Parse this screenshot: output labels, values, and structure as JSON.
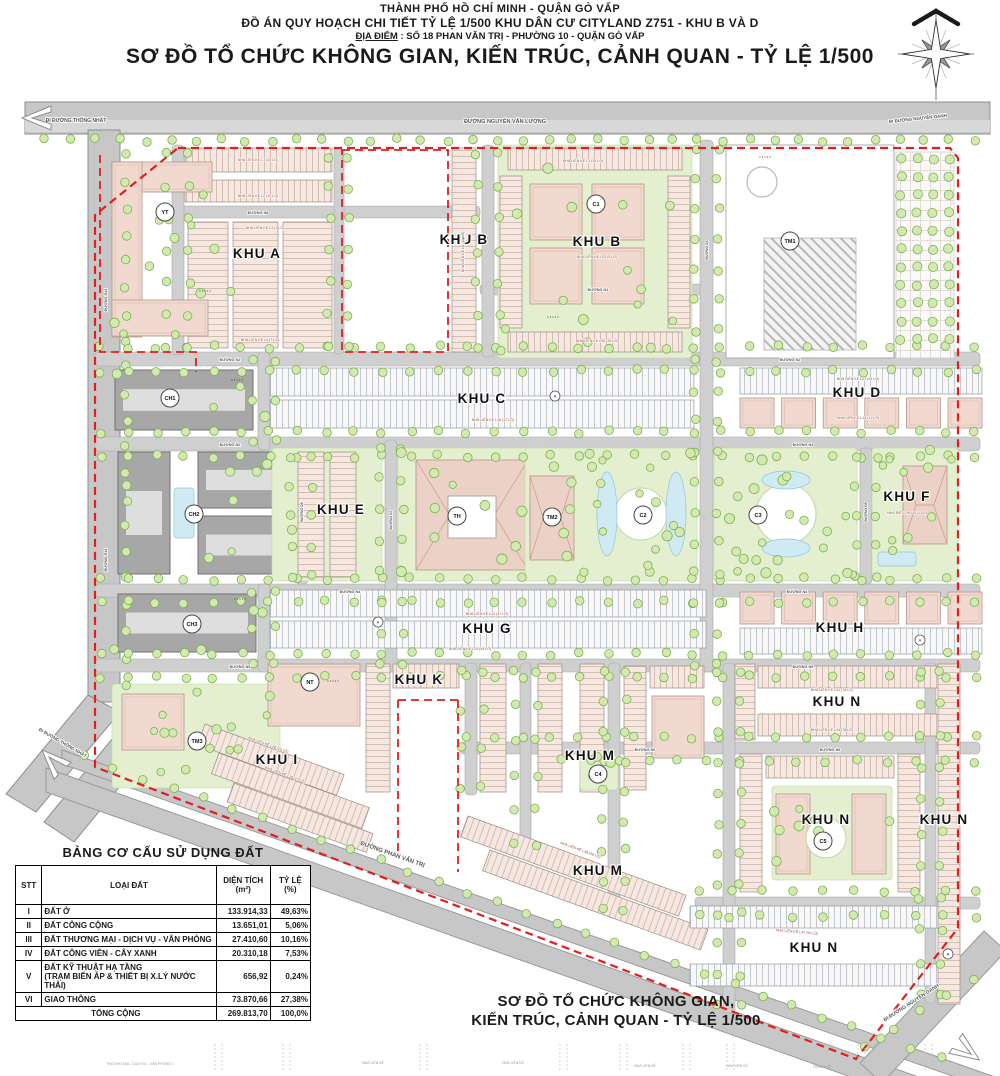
{
  "header": {
    "line1": "THÀNH PHỐ HỒ CHÍ MINH - QUẬN GÒ VẤP",
    "line2": "ĐỒ ÁN QUY HOẠCH CHI TIẾT TỶ LỆ 1/500 KHU DÂN CƯ CITYLAND Z751 - KHU B VÀ D",
    "line3_label": "ĐỊA ĐIỂM",
    "line3_rest": " : SỐ 18 PHAN VĂN TRỊ - PHƯỜNG 10 - QUẬN GÒ VẤP",
    "title": "SƠ ĐỒ TỔ CHỨC KHÔNG GIAN, KIẾN TRÚC, CẢNH QUAN - TỶ LỆ 1/500"
  },
  "caption": {
    "line1": "SƠ ĐỒ TỔ CHỨC KHÔNG GIAN,",
    "line2": "KIẾN TRÚC, CẢNH QUAN - TỶ LỆ 1/500"
  },
  "land_use_table": {
    "title": "BẢNG CƠ CẤU SỬ DỤNG ĐẤT",
    "columns": [
      "STT",
      "LOẠI ĐẤT",
      "DIỆN TÍCH\n(m²)",
      "TỶ LỆ\n(%)"
    ],
    "rows": [
      {
        "stt": "I",
        "loai": "ĐẤT Ở",
        "dien_tich": "133.914,33",
        "ty_le": "49,63%"
      },
      {
        "stt": "II",
        "loai": "ĐẤT CÔNG CỘNG",
        "dien_tich": "13.651,01",
        "ty_le": "5,06%"
      },
      {
        "stt": "III",
        "loai": "ĐẤT THƯƠNG MẠI - DỊCH VỤ - VĂN PHÒNG",
        "dien_tich": "27.410,60",
        "ty_le": "10,16%"
      },
      {
        "stt": "IV",
        "loai": "ĐẤT CÔNG VIÊN - CÂY XANH",
        "dien_tich": "20.310,18",
        "ty_le": "7,53%"
      },
      {
        "stt": "V",
        "loai": "ĐẤT KỸ THUẬT HẠ TẦNG\n(TRẠM BIẾN ÁP & THIẾT BỊ X.LÝ NƯỚC THẢI)",
        "dien_tich": "656,92",
        "ty_le": "0,24%"
      },
      {
        "stt": "VI",
        "loai": "GIAO THÔNG",
        "dien_tich": "73.870,66",
        "ty_le": "27,38%"
      }
    ],
    "total": {
      "label": "TỔNG CỘNG",
      "dien_tich": "269.813,70",
      "ty_le": "100,0%"
    }
  },
  "map": {
    "zones": [
      {
        "label": "KHU A",
        "x": 257,
        "y": 258
      },
      {
        "label": "KHU B",
        "x": 464,
        "y": 244
      },
      {
        "label": "KHU B",
        "x": 597,
        "y": 246
      },
      {
        "label": "KHU C",
        "x": 482,
        "y": 403
      },
      {
        "label": "KHU D",
        "x": 857,
        "y": 397
      },
      {
        "label": "KHU E",
        "x": 341,
        "y": 514
      },
      {
        "label": "KHU F",
        "x": 907,
        "y": 501
      },
      {
        "label": "KHU G",
        "x": 487,
        "y": 633
      },
      {
        "label": "KHU H",
        "x": 840,
        "y": 632
      },
      {
        "label": "KHU I",
        "x": 277,
        "y": 764
      },
      {
        "label": "KHU K",
        "x": 419,
        "y": 684
      },
      {
        "label": "KHU M",
        "x": 590,
        "y": 760
      },
      {
        "label": "KHU M",
        "x": 598,
        "y": 875
      },
      {
        "label": "KHU N",
        "x": 837,
        "y": 706
      },
      {
        "label": "KHU N",
        "x": 826,
        "y": 824
      },
      {
        "label": "KHU N",
        "x": 944,
        "y": 824
      },
      {
        "label": "KHU N",
        "x": 814,
        "y": 952
      }
    ],
    "facilities": [
      {
        "label": "YT",
        "x": 165,
        "y": 212
      },
      {
        "label": "C1",
        "x": 596,
        "y": 204
      },
      {
        "label": "TM1",
        "x": 790,
        "y": 241
      },
      {
        "label": "CH1",
        "x": 170,
        "y": 398
      },
      {
        "label": "CH2",
        "x": 194,
        "y": 514
      },
      {
        "label": "TM2",
        "x": 552,
        "y": 517
      },
      {
        "label": "TH",
        "x": 457,
        "y": 516
      },
      {
        "label": "C2",
        "x": 643,
        "y": 515
      },
      {
        "label": "C3",
        "x": 758,
        "y": 515
      },
      {
        "label": "CH3",
        "x": 192,
        "y": 624
      },
      {
        "label": "NT",
        "x": 310,
        "y": 682
      },
      {
        "label": "TM3",
        "x": 197,
        "y": 741
      },
      {
        "label": "C4",
        "x": 598,
        "y": 774
      },
      {
        "label": "C5",
        "x": 823,
        "y": 841
      }
    ],
    "small_circles": [
      {
        "label": "A",
        "x": 555,
        "y": 396
      },
      {
        "label": "A",
        "x": 378,
        "y": 622
      },
      {
        "label": "A",
        "x": 920,
        "y": 640
      },
      {
        "label": "A",
        "x": 948,
        "y": 954
      }
    ],
    "road_labels": [
      {
        "text": "ĐI ĐƯỜNG THỐNG NHẤT",
        "x": 76,
        "y": 122,
        "a": 0,
        "s": 5
      },
      {
        "text": "ĐƯỜNG NGUYỄN VĂN LƯỢNG",
        "x": 505,
        "y": 123,
        "a": 0,
        "s": 5.5
      },
      {
        "text": "ĐI ĐƯỜNG NGUYỄN OANH",
        "x": 918,
        "y": 120,
        "a": -6,
        "s": 4.5
      },
      {
        "text": "ĐI ĐƯỜNG THỐNG NHẤT",
        "x": 62,
        "y": 744,
        "a": 30,
        "s": 4.5
      },
      {
        "text": "ĐƯỜNG PHAN VĂN TRỊ",
        "x": 392,
        "y": 856,
        "a": 19.5,
        "s": 6
      },
      {
        "text": "ĐI ĐƯỜNG NGUYỄN OANH",
        "x": 912,
        "y": 1004,
        "a": -33,
        "s": 5
      },
      {
        "text": "ĐƯỜNG N8",
        "x": 258,
        "y": 214,
        "a": 0,
        "s": 3.8
      },
      {
        "text": "ĐƯỜNG N1",
        "x": 598,
        "y": 291,
        "a": 0,
        "s": 3.8
      },
      {
        "text": "ĐƯỜNG N2",
        "x": 230,
        "y": 361,
        "a": 0,
        "s": 3.8
      },
      {
        "text": "ĐƯỜNG N2",
        "x": 790,
        "y": 361,
        "a": 0,
        "s": 3.8
      },
      {
        "text": "ĐƯỜNG N2",
        "x": 230,
        "y": 446,
        "a": 0,
        "s": 3.8
      },
      {
        "text": "ĐƯỜNG N3",
        "x": 803,
        "y": 446,
        "a": 0,
        "s": 3.8
      },
      {
        "text": "ĐƯỜNG N4",
        "x": 350,
        "y": 593,
        "a": 0,
        "s": 3.8
      },
      {
        "text": "ĐƯỜNG N4",
        "x": 797,
        "y": 593,
        "a": 0,
        "s": 3.8
      },
      {
        "text": "ĐƯỜNG N5",
        "x": 240,
        "y": 668,
        "a": 0,
        "s": 3.8
      },
      {
        "text": "ĐƯỜNG N5",
        "x": 803,
        "y": 668,
        "a": 0,
        "s": 3.8
      },
      {
        "text": "ĐƯỜNG N6",
        "x": 645,
        "y": 751,
        "a": 0,
        "s": 3.8
      },
      {
        "text": "ĐƯỜNG N6",
        "x": 830,
        "y": 751,
        "a": 0,
        "s": 3.8
      },
      {
        "text": "ĐƯỜNG D14",
        "x": 107,
        "y": 300,
        "a": -90,
        "s": 3.8
      },
      {
        "text": "ĐƯỜNG D14",
        "x": 107,
        "y": 560,
        "a": -90,
        "s": 3.8
      },
      {
        "text": "ĐƯỜNG D6",
        "x": 303,
        "y": 512,
        "a": -90,
        "s": 3.5
      },
      {
        "text": "ĐƯỜNG D7",
        "x": 392,
        "y": 520,
        "a": -90,
        "s": 3.5
      },
      {
        "text": "ĐƯỜNG D3",
        "x": 708,
        "y": 250,
        "a": -90,
        "s": 3.5
      },
      {
        "text": "ĐƯỜNG D9",
        "x": 867,
        "y": 512,
        "a": -90,
        "s": 3.5
      }
    ],
    "block_labels": [
      {
        "text": "NHÀ LIÊN KẾ L1 (10 LÔ)",
        "x": 258,
        "y": 161,
        "a": 0
      },
      {
        "text": "NHÀ LIÊN KẾ L2 (10 LÔ)",
        "x": 258,
        "y": 197,
        "a": 0
      },
      {
        "text": "NHÀ LIÊN KẾ L3 (7 LÔ)",
        "x": 265,
        "y": 229,
        "a": 0
      },
      {
        "text": "NHÀ LIÊN KẾ L4 (7 LÔ)",
        "x": 260,
        "y": 341,
        "a": 0
      },
      {
        "text": "NHÀ LIÊN KẾ L1 (26 LÔ)",
        "x": 583,
        "y": 162,
        "a": 0
      },
      {
        "text": "NHÀ LIÊN KẾ L03 (9 LÔ)",
        "x": 597,
        "y": 258,
        "a": 0
      },
      {
        "text": "NHÀ LIÊN KẾ L05 (35 LÔ)",
        "x": 597,
        "y": 342,
        "a": 0
      },
      {
        "text": "NHÀ LIÊN KẾ L16 (47 LÔ)",
        "x": 493,
        "y": 421,
        "a": 0
      },
      {
        "text": "NHÀ LIÊN KẾ L21 (24 LÔ)",
        "x": 858,
        "y": 380,
        "a": 0
      },
      {
        "text": "NHÀ LIÊN KẾ L15 (11 LÔ)",
        "x": 858,
        "y": 419,
        "a": 0
      },
      {
        "text": "NHÀ BIỆT THỰ B (1 LÔ)",
        "x": 907,
        "y": 514,
        "a": 0
      },
      {
        "text": "NHÀ LIÊN KẾ L24 (47 LÔ)",
        "x": 487,
        "y": 615,
        "a": 0
      },
      {
        "text": "NHÀ LIÊN KẾ L25 (49 LÔ)",
        "x": 470,
        "y": 650,
        "a": 0
      },
      {
        "text": "NHÀ LIÊN KẾ L41 (78 LÔ)",
        "x": 832,
        "y": 691,
        "a": 0
      },
      {
        "text": "NHÀ LIÊN KẾ L44 (78 LÔ)",
        "x": 832,
        "y": 731,
        "a": 0
      },
      {
        "text": "NHÀ LIÊN KẾ L28 (10 LÔ)",
        "x": 268,
        "y": 746,
        "a": 20
      },
      {
        "text": "NHÀ LIÊN KẾ L29 (12 LÔ)",
        "x": 285,
        "y": 776,
        "a": 20
      },
      {
        "text": "NHÀ LIÊN KẾ L38 (29 LÔ)",
        "x": 580,
        "y": 851,
        "a": 20
      },
      {
        "text": "NHÀ LIÊN KẾ L47 (50 LÔ)",
        "x": 797,
        "y": 933,
        "a": 5
      },
      {
        "text": "NHÀ LIÊN KẾ L8 (10 LÔ)",
        "x": 464,
        "y": 252,
        "a": -90
      }
    ],
    "section_strip_labels": [
      {
        "text": "THƯƠNG MẠI - DỊCH VỤ - VĂN PHÒNG 1",
        "x": 140,
        "y": 1065
      },
      {
        "text": "NHÀ LIÊN KẾ",
        "x": 373,
        "y": 1064
      },
      {
        "text": "NHÀ LIÊN KẾ",
        "x": 513,
        "y": 1064
      },
      {
        "text": "NHÀ LIÊN KẾ",
        "x": 645,
        "y": 1067
      },
      {
        "text": "NHÀ LIÊN KẾ",
        "x": 737,
        "y": 1067
      },
      {
        "text": "TRẠM Y TẾ",
        "x": 822,
        "y": 1068
      }
    ],
    "colors": {
      "boundary": "#e31e1e",
      "road": "#c7c7c7",
      "inner_road": "#cfcfcf",
      "tree_fill": "#d3e9b0",
      "tree_stroke": "#7cb153",
      "lot_fill": "#f6e8e1",
      "park_fill": "#e3efcf",
      "water_fill": "#cfeaf3",
      "apartment_fill": "#a7a7a7"
    }
  }
}
